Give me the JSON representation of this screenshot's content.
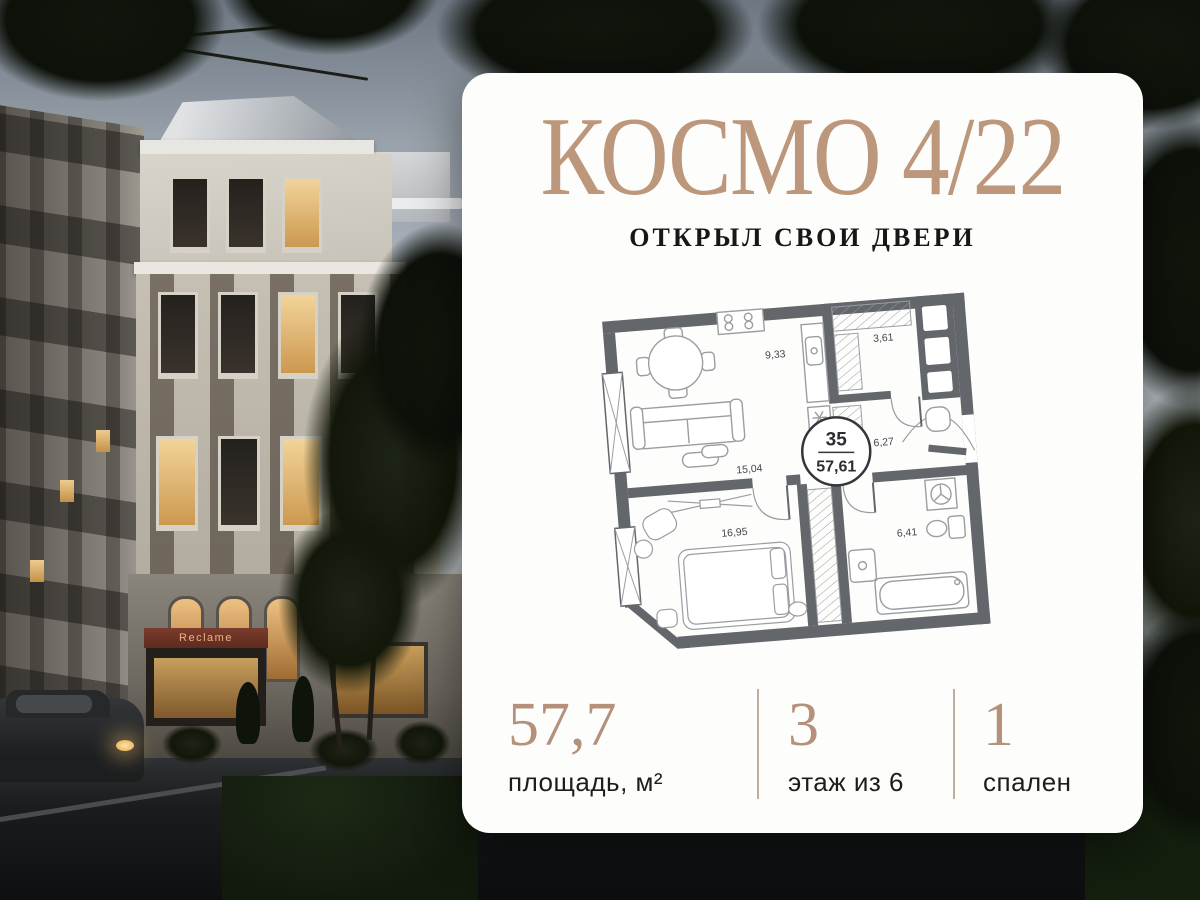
{
  "brand": {
    "title": "КОСМО 4/22",
    "subtitle": "ОТКРЫЛ СВОИ ДВЕРИ"
  },
  "floor_plan": {
    "unit_number": "35",
    "total_area": "57,61",
    "areas": {
      "kitchen": "9,33",
      "wardrobe": "3,61",
      "hallway": "6,27",
      "living": "15,04",
      "bedroom": "16,95",
      "bathroom": "6,41"
    }
  },
  "stats": [
    {
      "value": "57,7",
      "label": "площадь, м²"
    },
    {
      "value": "3",
      "label": "этаж из 6"
    },
    {
      "value": "1",
      "label": "спален"
    }
  ],
  "photo": {
    "storefront_sign": "Reclame"
  },
  "colors": {
    "accent_tan": "#bd977c",
    "card_bg": "#fdfdfc",
    "plan_wall": "#63666b",
    "plan_line": "#9a9da1"
  }
}
